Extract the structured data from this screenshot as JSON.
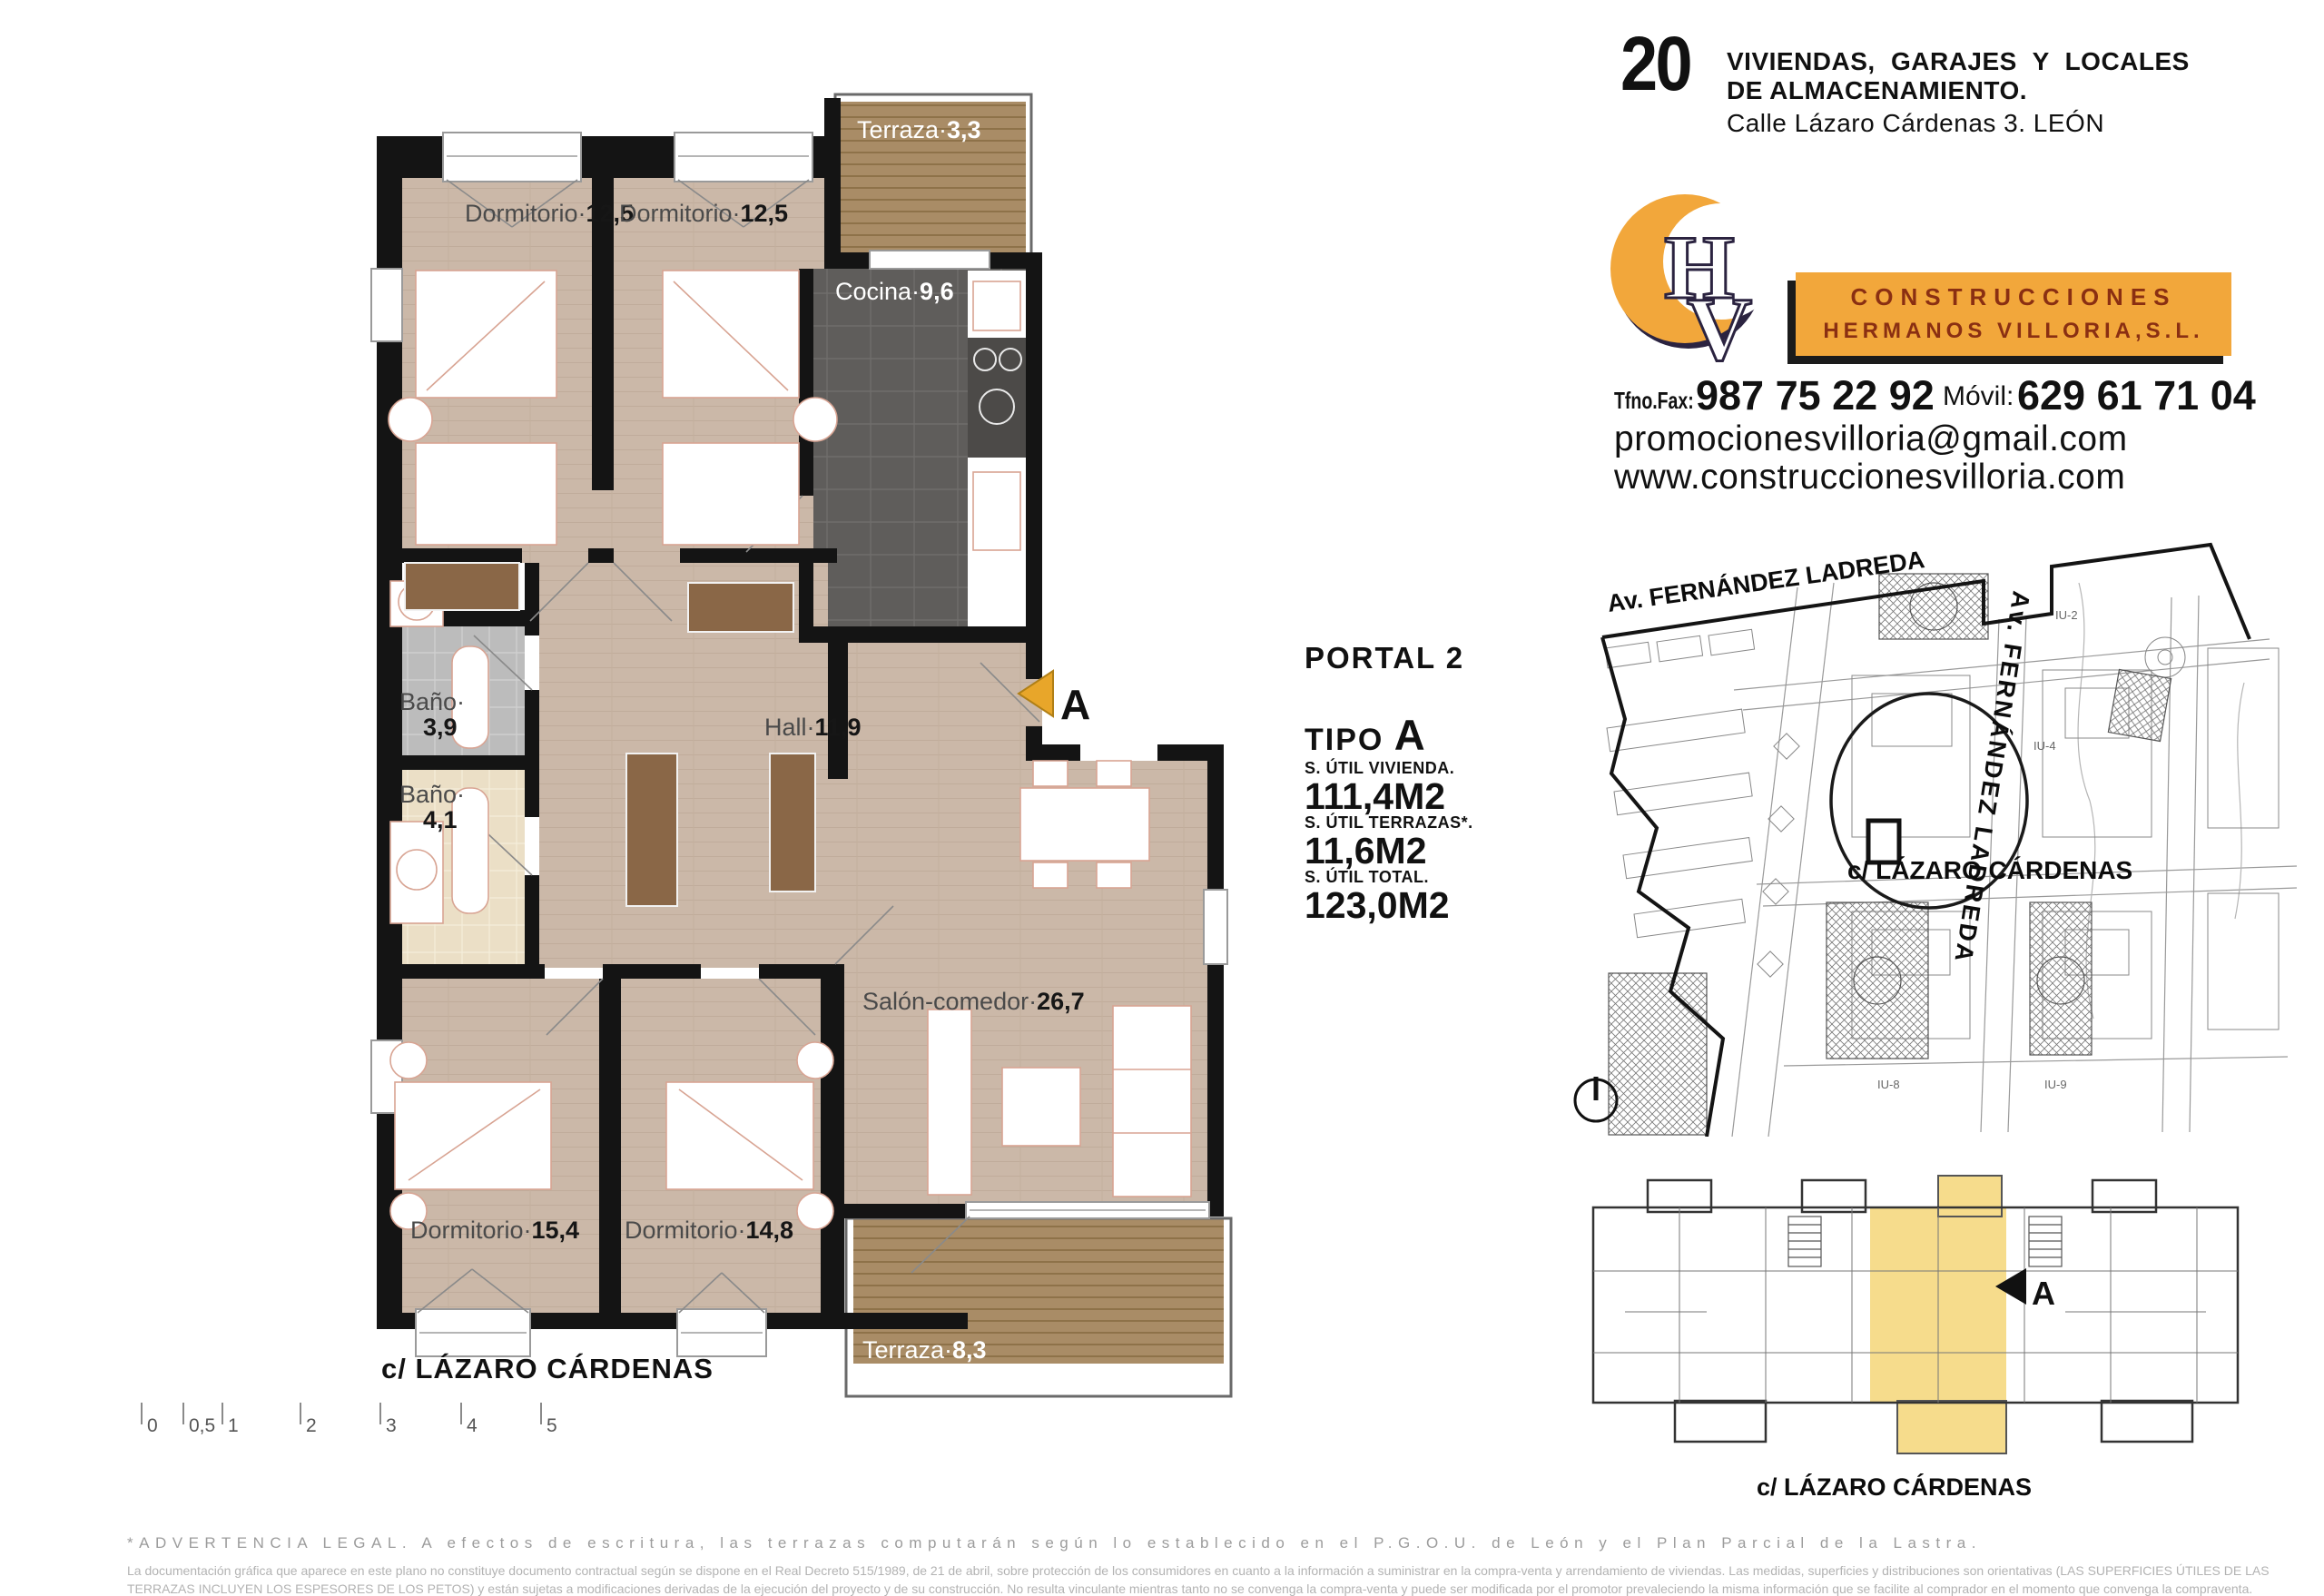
{
  "header": {
    "number": "20",
    "title_line1": "VIVIENDAS, GARAJES Y LOCALES",
    "title_line2": "DE ALMACENAMIENTO.",
    "address": "Calle Lázaro Cárdenas 3. LEÓN"
  },
  "logo": {
    "monogram_h": "H",
    "monogram_v": "V",
    "banner_line1": "CONSTRUCCIONES",
    "banner_line2": "HERMANOS VILLORIA,S.L.",
    "accent_color": "#F2A73B",
    "banner_text_color": "#8A2F12"
  },
  "contact": {
    "phone_label": "Tfno.Fax:",
    "phone": "987 75 22 92",
    "mobile_label": "Móvil:",
    "mobile": "629 61 71 04",
    "email": "promocionesvilloria@gmail.com",
    "website": "www.construccionesvilloria.com"
  },
  "unit": {
    "portal": "PORTAL 2",
    "tipo_label": "TIPO",
    "tipo_value": "A",
    "area1_label": "S. ÚTIL VIVIENDA.",
    "area1_value": "111,4M2",
    "area2_label": "S. ÚTIL TERRAZAS*.",
    "area2_value": "11,6M2",
    "area3_label": "S. ÚTIL TOTAL.",
    "area3_value": "123,0M2"
  },
  "plan": {
    "street": "c/ LÁZARO CÁRDENAS",
    "section_marker": "A",
    "rooms": [
      {
        "name": "Terraza·",
        "value": "3,3"
      },
      {
        "name": "Dormitorio·",
        "value": "12,5"
      },
      {
        "name": "Dormitorio·",
        "value": "12,5"
      },
      {
        "name": "Cocina·",
        "value": "9,6"
      },
      {
        "name": "Baño·",
        "value": "3,9"
      },
      {
        "name": "Baño·",
        "value": "4,1"
      },
      {
        "name": "Hall·",
        "value": "11,9"
      },
      {
        "name": "Salón-comedor·",
        "value": "26,7"
      },
      {
        "name": "Dormitorio·",
        "value": "15,4"
      },
      {
        "name": "Dormitorio·",
        "value": "14,8"
      },
      {
        "name": "Terraza·",
        "value": "8,3"
      }
    ],
    "colors": {
      "wood": "#CBB8A8",
      "terrace_wood": "#A98C66",
      "kitchen_tile": "#5F5D5B",
      "bath_gray": "#BCBCBC",
      "bath_cream": "#EBDFC6",
      "wall": "#141414",
      "marker_orange": "#E8A62A"
    }
  },
  "scalebar": {
    "ticks": [
      "0",
      "0,5",
      "1",
      "2",
      "3",
      "4",
      "5"
    ]
  },
  "map": {
    "street_diagonal": "Av. FERNÁNDEZ LADREDA",
    "street_vertical": "Av. FERNÁNDEZ LADREDA",
    "street_bottom": "c/ LÁZARO CÁRDENAS",
    "labels": [
      "IU-2",
      "IU-4",
      "IU-8",
      "IU-9"
    ]
  },
  "keyplan": {
    "street": "c/ LÁZARO CÁRDENAS",
    "marker": "A",
    "highlight_color": "#F6DC8C"
  },
  "legal": {
    "warning": "*ADVERTENCIA LEGAL. A efectos de escritura, las terrazas computarán según lo establecido en el P.G.O.U. de León y el Plan Parcial de la Lastra.",
    "line1": "La documentación gráfica que aparece en este plano no constituye documento contractual según se dispone en el Real Decreto 515/1989, de 21 de abril, sobre protección de los consumidores en cuanto a la información a suministrar en la compra-venta y arrendamiento de viviendas. Las medidas, superficies y distribuciones son orientativas (LAS SUPERFICIES ÚTILES DE LAS",
    "line2": "TERRAZAS INCLUYEN LOS ESPESORES DE LOS PETOS) y están sujetas a modificaciones derivadas de la ejecución del proyecto y de su construcción. No resulta vinculante mientras tanto no se convenga la compra-venta y puede ser modificada por el promotor prevaleciendo la misma información que se facilite al comprador en el momento que convenga la compraventa."
  }
}
